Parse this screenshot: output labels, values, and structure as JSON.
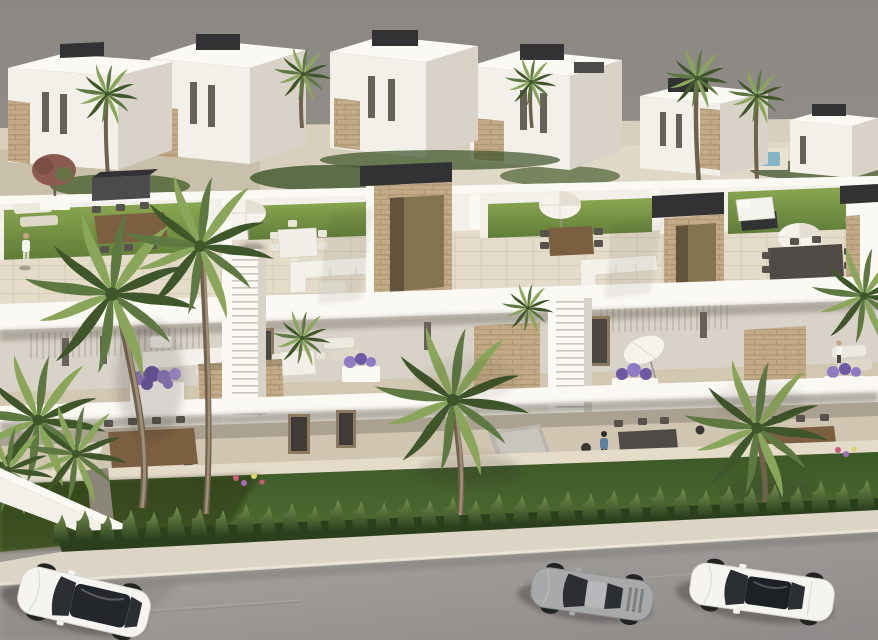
{
  "scene": {
    "type": "aerial-architectural-render",
    "description": "Aerial 3D rendering of a modern white residential development: a long block of townhouses with rooftop terraces (lawns, parasols, outdoor sofas and dining sets), a balcony level with purple flower planters and stone-clad feature panels, ground-floor terraces with wooden dining tables, a private garden strip with tall fan palms, a trimmed conical hedge along the pavement, and a grey street in the foreground with three parked cars. A second row of white villas with tan stone accents and palm trees sits behind, against a plain warm-grey backdrop.",
    "time_of_day": "daylight",
    "objects": {
      "background_villas": 6,
      "roof_terraces": 4,
      "stair_towers": 3,
      "pergola_roof_boxes": 2,
      "parasols": 4,
      "foreground_palm_trees": 6,
      "background_palm_trees": 5,
      "flower_planters": 4,
      "dining_sets": 6,
      "outdoor_sofas": 4,
      "people": 3,
      "hedge_bushes": 36,
      "cars": 3,
      "swimming_pools": 1
    },
    "vehicles": [
      {
        "name": "white-suv",
        "body_color": "#f5f4f1",
        "roof": "panoramic-glass",
        "position": "left"
      },
      {
        "name": "silver-coupe",
        "body_color": "#a7a9ab",
        "roof": "glass",
        "position": "middle"
      },
      {
        "name": "white-sedan",
        "body_color": "#f5f4f1",
        "roof": "panoramic-glass",
        "position": "right"
      }
    ]
  },
  "palette": {
    "wall": "#f3f0e9",
    "wallBright": "#fbf9f4",
    "wallShade": "#d8d2c8",
    "wallDim": "#c6c0b5",
    "tile": "#e4dbc9",
    "tileShade": "#d2c7b1",
    "cap": "#4b4b4d",
    "capDark": "#323234",
    "wood": "#7c5e40",
    "woodD": "#5a4530",
    "sofaC": "#f3f1ea",
    "winC": "#676259",
    "palm1": "#8aa65a",
    "palm2": "#5d7841",
    "palm3": "#3e5629",
    "trunk": "#a18f75",
    "trunkD": "#6f614d",
    "shadow": "rgba(52,47,41,0.35)",
    "flower": "#8f7bc3",
    "flowerD": "#6d58a3",
    "swalk": "#dcd5c5",
    "road1": "#a7a4a0",
    "road2": "#8e8b88",
    "carW": "#f5f4f1",
    "silver": "#a7a9ab",
    "glass": "#2b2f33",
    "hedge1": "#6d8751",
    "hedge2": "#2c3f1d",
    "poolC": "#84b5c6",
    "skin": "#c9a183",
    "blue": "#5d80a6",
    "sky1": "#8c8884",
    "sky2": "#a29d97"
  }
}
